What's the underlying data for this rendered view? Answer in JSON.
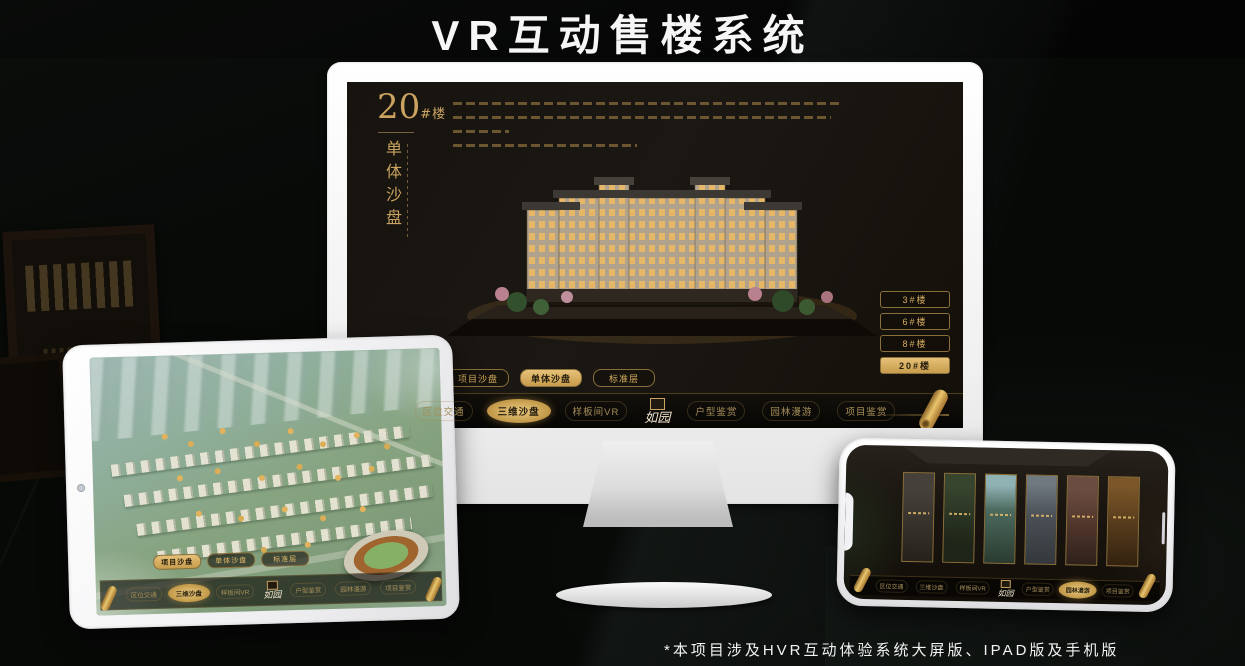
{
  "title": "VR互动售楼系统",
  "footnote": "*本项目涉及HVR互动体验系统大屏版、IPAD版及手机版",
  "brand": {
    "logo_text": "如园"
  },
  "colors": {
    "gold": "#c9a35f",
    "gold_bright": "#e6c178",
    "screen_bg": "#17130f",
    "nav_text": "#a68e58"
  },
  "monitor": {
    "heading": {
      "number": "20",
      "suffix": "#楼",
      "subtitle_vertical": "单体沙盘"
    },
    "floor_buttons": [
      {
        "label": "3#楼",
        "active": false
      },
      {
        "label": "6#楼",
        "active": false
      },
      {
        "label": "8#楼",
        "active": false
      },
      {
        "label": "20#楼",
        "active": true
      }
    ],
    "mode_tabs": [
      {
        "label": "项目沙盘",
        "active": false
      },
      {
        "label": "单体沙盘",
        "active": true
      },
      {
        "label": "标准层",
        "active": false
      }
    ],
    "nav": {
      "logo": "如园",
      "items": [
        {
          "label": "区位交通",
          "active": false
        },
        {
          "label": "三维沙盘",
          "active": true
        },
        {
          "label": "样板间VR",
          "active": false
        },
        {
          "label": "户型鉴赏",
          "active": false
        },
        {
          "label": "园林漫游",
          "active": false
        },
        {
          "label": "项目鉴赏",
          "active": false
        }
      ]
    }
  },
  "tablet": {
    "mode_tabs": [
      {
        "label": "项目沙盘",
        "active": true
      },
      {
        "label": "单体沙盘",
        "active": false
      },
      {
        "label": "标准层",
        "active": false
      }
    ],
    "nav": {
      "logo": "如园",
      "items": [
        {
          "label": "区位交通",
          "active": false
        },
        {
          "label": "三维沙盘",
          "active": true
        },
        {
          "label": "样板间VR",
          "active": false
        },
        {
          "label": "户型鉴赏",
          "active": false
        },
        {
          "label": "园林漫游",
          "active": false
        },
        {
          "label": "项目鉴赏",
          "active": false
        }
      ]
    }
  },
  "phone": {
    "nav": {
      "logo": "如园",
      "items": [
        {
          "label": "区位交通",
          "active": false
        },
        {
          "label": "三维沙盘",
          "active": false
        },
        {
          "label": "样板间VR",
          "active": false
        },
        {
          "label": "户型鉴赏",
          "active": false
        },
        {
          "label": "园林漫游",
          "active": true
        },
        {
          "label": "项目鉴赏",
          "active": false
        }
      ]
    }
  }
}
